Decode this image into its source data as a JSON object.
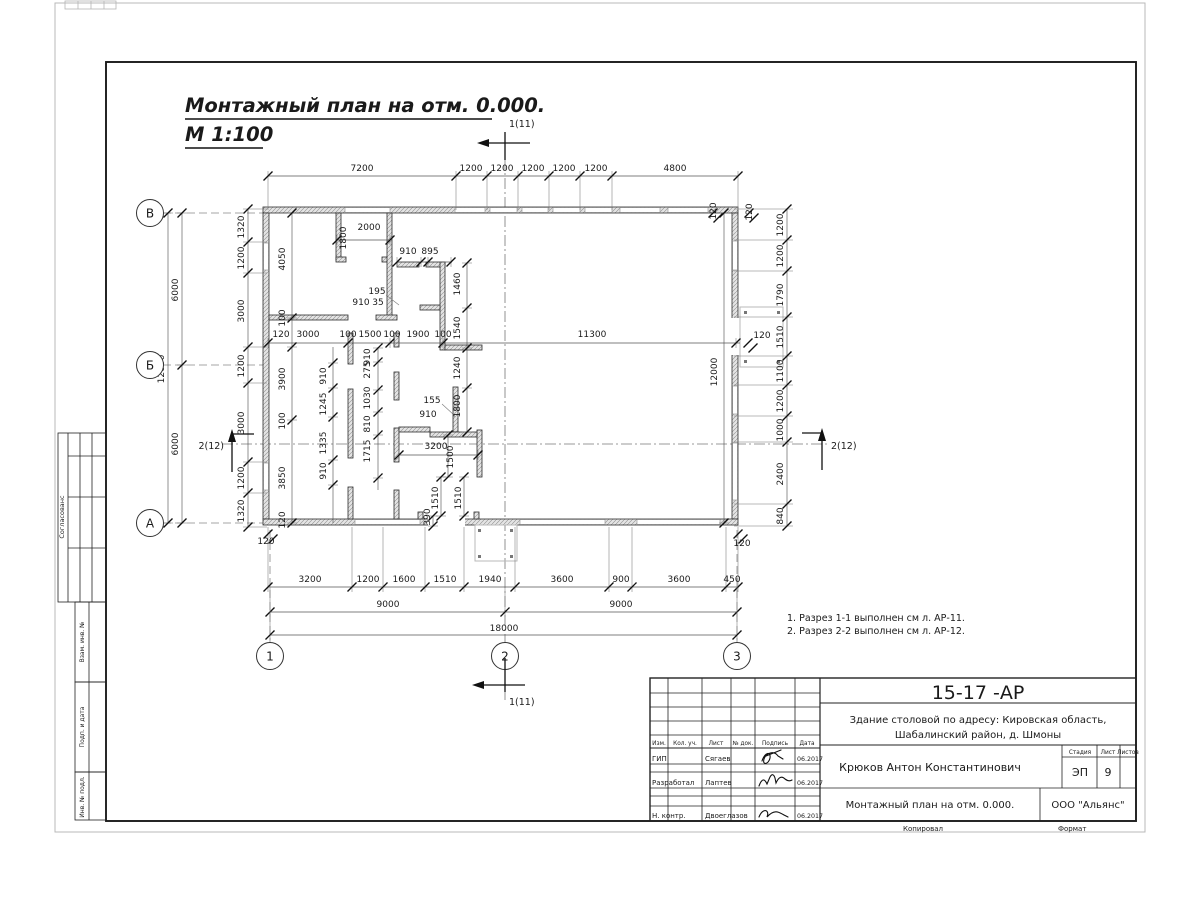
{
  "title": {
    "line1": "Монтажный план на отм. 0.000.",
    "line2": "М 1:100"
  },
  "notes": {
    "line1": "1. Разрез 1-1 выполнен см л. АР-11.",
    "line2": "2. Разрез 2-2 выполнен см л. АР-12."
  },
  "plan": {
    "axis_circles": [
      [
        "В",
        150,
        213
      ],
      [
        "Б",
        150,
        365
      ],
      [
        "А",
        150,
        523
      ],
      [
        "1",
        270,
        656
      ],
      [
        "2",
        505,
        656
      ],
      [
        "3",
        737,
        656
      ]
    ],
    "section_labels": [
      [
        "1(11)",
        509,
        127,
        "start"
      ],
      [
        "1(11)",
        509,
        705,
        "start"
      ],
      [
        "2(12)",
        224,
        449,
        "end"
      ],
      [
        "2(12)",
        831,
        449,
        "start"
      ]
    ],
    "labels": [
      [
        "7200",
        362,
        171,
        0
      ],
      [
        "1200",
        471,
        171,
        0
      ],
      [
        "1200",
        502,
        171,
        0
      ],
      [
        "1200",
        533,
        171,
        0
      ],
      [
        "1200",
        564,
        171,
        0
      ],
      [
        "1200",
        596,
        171,
        0
      ],
      [
        "4800",
        675,
        171,
        0
      ],
      [
        "1320",
        244,
        227,
        1
      ],
      [
        "1200",
        244,
        258,
        1
      ],
      [
        "3000",
        244,
        311,
        1
      ],
      [
        "1200",
        244,
        366,
        1
      ],
      [
        "3000",
        244,
        423,
        1
      ],
      [
        "1200",
        244,
        478,
        1
      ],
      [
        "1320",
        244,
        511,
        1
      ],
      [
        "6000",
        178,
        290,
        1
      ],
      [
        "6000",
        178,
        444,
        1
      ],
      [
        "12000",
        164,
        369,
        1
      ],
      [
        "1200",
        783,
        225,
        1
      ],
      [
        "1200",
        783,
        256,
        1
      ],
      [
        "1790",
        783,
        295,
        1
      ],
      [
        "1510",
        783,
        337,
        1
      ],
      [
        "1100",
        783,
        371,
        1
      ],
      [
        "1200",
        783,
        401,
        1
      ],
      [
        "1000",
        783,
        430,
        1
      ],
      [
        "2400",
        783,
        474,
        1
      ],
      [
        "840",
        783,
        516,
        1
      ],
      [
        "3200",
        310,
        582,
        0
      ],
      [
        "1200",
        368,
        582,
        0
      ],
      [
        "1600",
        404,
        582,
        0
      ],
      [
        "1510",
        445,
        582,
        0
      ],
      [
        "1940",
        490,
        582,
        0
      ],
      [
        "3600",
        562,
        582,
        0
      ],
      [
        "900",
        621,
        582,
        0
      ],
      [
        "3600",
        679,
        582,
        0
      ],
      [
        "450",
        732,
        582,
        0
      ],
      [
        "9000",
        388,
        607,
        0
      ],
      [
        "9000",
        621,
        607,
        0
      ],
      [
        "18000",
        504,
        631,
        0
      ],
      [
        "120",
        281,
        337,
        0
      ],
      [
        "3000",
        308,
        337,
        0
      ],
      [
        "100",
        348,
        337,
        0
      ],
      [
        "1500",
        370,
        337,
        0
      ],
      [
        "100",
        392,
        337,
        0
      ],
      [
        "1900",
        418,
        337,
        0
      ],
      [
        "100",
        443,
        337,
        0
      ],
      [
        "11300",
        592,
        337,
        0
      ],
      [
        "120",
        762,
        338,
        0
      ],
      [
        "120",
        266,
        544,
        0
      ],
      [
        "120",
        742,
        546,
        0
      ],
      [
        "120",
        716,
        211,
        1
      ],
      [
        "120",
        752,
        212,
        1
      ],
      [
        "4050",
        285,
        259,
        1
      ],
      [
        "100",
        285,
        318,
        1
      ],
      [
        "3900",
        285,
        379,
        1
      ],
      [
        "100",
        285,
        421,
        1
      ],
      [
        "3850",
        285,
        478,
        1
      ],
      [
        "120",
        285,
        520,
        1
      ],
      [
        "910",
        326,
        376,
        1
      ],
      [
        "1245",
        326,
        404,
        1
      ],
      [
        "1335",
        326,
        443,
        1
      ],
      [
        "910",
        326,
        471,
        1
      ],
      [
        "910",
        370,
        357,
        1
      ],
      [
        "275",
        370,
        370,
        1
      ],
      [
        "1030",
        370,
        398,
        1
      ],
      [
        "810",
        370,
        424,
        1
      ],
      [
        "1715",
        370,
        451,
        1
      ],
      [
        "1800",
        346,
        238,
        1
      ],
      [
        "2000",
        369,
        230,
        0
      ],
      [
        "910",
        408,
        254,
        0
      ],
      [
        "895",
        430,
        254,
        0
      ],
      [
        "195",
        377,
        294,
        0
      ],
      [
        "910",
        361,
        305,
        0
      ],
      [
        "35",
        378,
        305,
        0
      ],
      [
        "1460",
        460,
        284,
        1
      ],
      [
        "1540",
        460,
        328,
        1
      ],
      [
        "1240",
        460,
        368,
        1
      ],
      [
        "1800",
        460,
        406,
        1
      ],
      [
        "155",
        432,
        403,
        0
      ],
      [
        "910",
        428,
        417,
        0
      ],
      [
        "3200",
        436,
        449,
        0
      ],
      [
        "1500",
        453,
        457,
        1
      ],
      [
        "1510",
        438,
        498,
        1
      ],
      [
        "1510",
        461,
        498,
        1
      ],
      [
        "390",
        430,
        517,
        1
      ],
      [
        "12000",
        717,
        372,
        1
      ]
    ]
  },
  "title_block": {
    "code": "15-17 -АР",
    "object_line1": "Здание столовой по адресу: Кировская область,",
    "object_line2": "Шабалинский район, д. Шмоны",
    "designer_name": "Крюков Антон Константинович",
    "sheet_title": "Монтажный план на отм. 0.000.",
    "company": "ООО \"Альянс\"",
    "stage_label": "Стадия",
    "stage_value": "ЭП",
    "sheet_label": "Лист",
    "sheet_value": "9",
    "sheets_label": "Листов",
    "header_cols": [
      "Изм.",
      "Кол. уч.",
      "Лист",
      "№ док.",
      "Подпись",
      "Дата"
    ],
    "rows": [
      {
        "role": "ГИП",
        "name": "Сягаев",
        "date": "06.2017"
      },
      {
        "role": "Разработал",
        "name": "Лаптев",
        "date": "06.2017"
      },
      {
        "role": "Н. контр.",
        "name": "Двоеглазов",
        "date": "06.2017"
      }
    ],
    "footer_left": "Копировал",
    "footer_right": "Формат"
  },
  "side_strips": {
    "approve": "Согласованс",
    "strip1": "Взам. инв. №",
    "strip2": "Подп. и дата",
    "strip3": "Инв. № подл."
  }
}
